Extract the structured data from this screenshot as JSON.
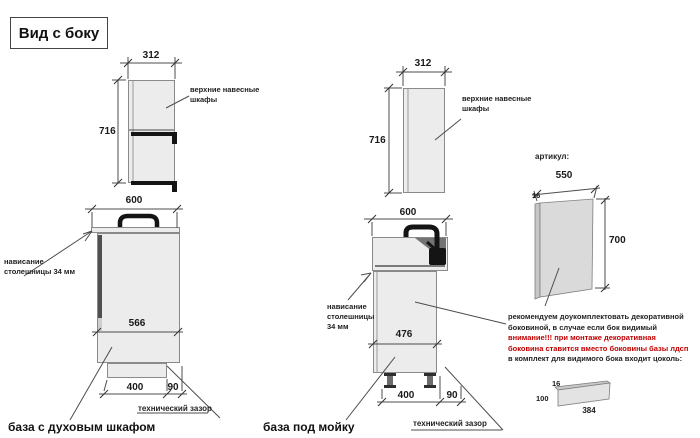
{
  "title": "Вид с боку",
  "colors": {
    "warning_red": "#c00000",
    "cabinet_fill": "#ececec",
    "line": "#4d4d4d"
  },
  "left_drawing": {
    "wall_cabinet_label_line1": "верхние навесные",
    "wall_cabinet_label_line2": "шкафы",
    "dim_wall_width": "312",
    "dim_wall_height": "716",
    "dim_counter_width": "600",
    "overhang_note_line1": "нависание",
    "overhang_note_line2": "столешницы 34 мм",
    "dim_inner_width": "566",
    "dim_plinth_width": "400",
    "dim_gap": "90",
    "tech_gap_label": "технический зазор",
    "caption": "база с духовым шкафом"
  },
  "middle_drawing": {
    "wall_cabinet_label_line1": "верхние навесные",
    "wall_cabinet_label_line2": "шкафы",
    "dim_wall_width": "312",
    "dim_wall_height": "716",
    "dim_counter_width": "600",
    "overhang_note_line1": "нависание",
    "overhang_note_line2": "столешницы",
    "overhang_note_line3": "34 мм",
    "dim_inner_width": "476",
    "dim_plinth_width": "400",
    "dim_gap": "90",
    "tech_gap_label": "технический зазор",
    "caption": "база под мойку"
  },
  "side_panel": {
    "artikul_label": "артикул:",
    "dim_width": "550",
    "dim_thickness": "16",
    "dim_height": "700",
    "note_line1": "рекомендуем доукомплектовать декоративной",
    "note_line2": "боковиной, в случае если бок видимый",
    "note_line3": "внимание!!! при монтаже декоративная",
    "note_line4": "боковина ставится вместо боковины базы лдсп",
    "note_line5": "в комплект для видимого бока входит цоколь:",
    "plinth_dim_thickness": "16",
    "plinth_dim_height": "100",
    "plinth_dim_width": "384"
  }
}
